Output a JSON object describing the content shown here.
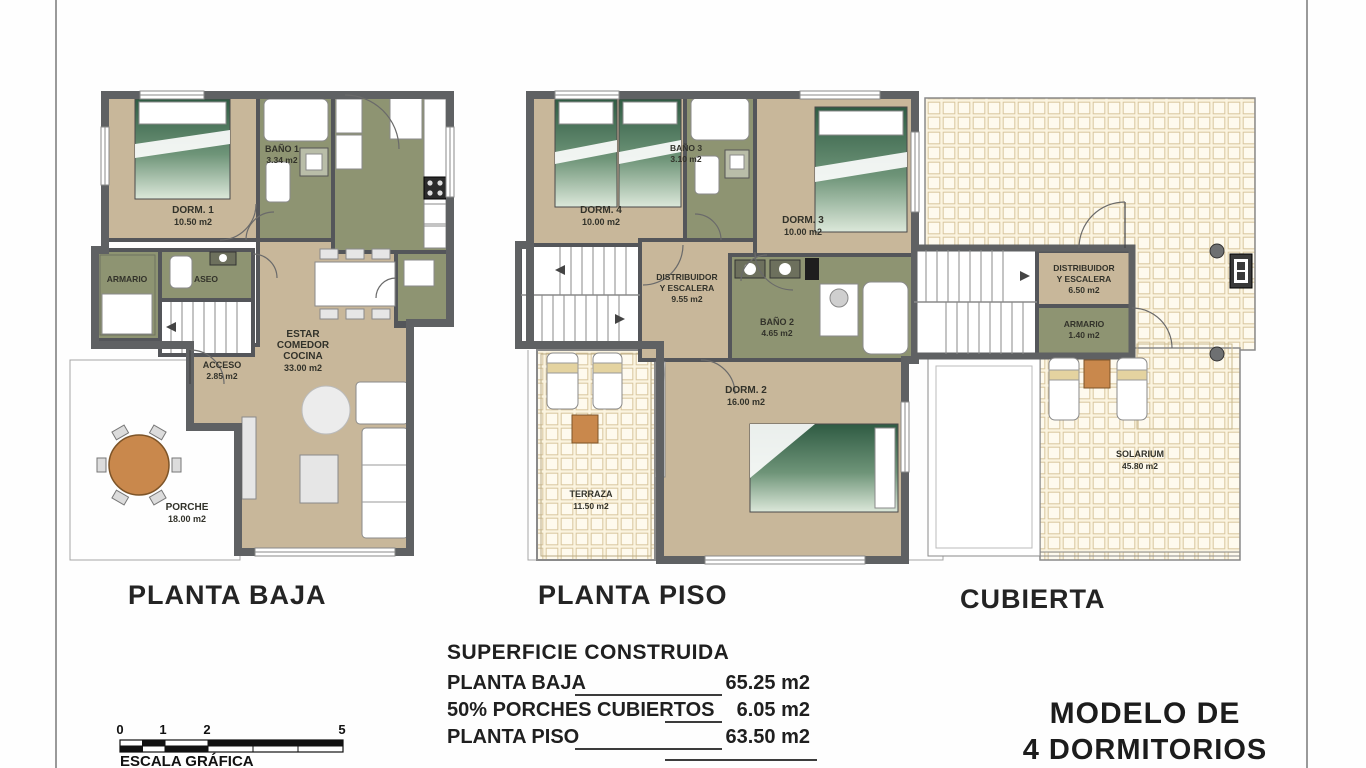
{
  "colors": {
    "wall_gray": "#5F6163",
    "floor_tan": "#C8B79A",
    "wet_room_olive": "#8E9472",
    "tile_cream": "#FBF4E0",
    "accent_orange": "#C9884C",
    "bed_green": "#2F5B43",
    "text": "#222222"
  },
  "plans": {
    "planta_baja": {
      "title": "PLANTA BAJA",
      "rooms": {
        "dorm1": {
          "lines": [
            "DORM. 1",
            "10.50 m2"
          ]
        },
        "bano1": {
          "lines": [
            "BAÑO 1",
            "3.34 m2"
          ]
        },
        "armario": {
          "lines": [
            "ARMARIO"
          ]
        },
        "aseo": {
          "lines": [
            "ASEO"
          ]
        },
        "estar": {
          "lines": [
            "ESTAR",
            "COMEDOR",
            "COCINA",
            "33.00 m2"
          ]
        },
        "acceso": {
          "lines": [
            "ACCESO",
            "2.85 m2"
          ]
        },
        "porche": {
          "lines": [
            "PORCHE",
            "18.00 m2"
          ]
        }
      }
    },
    "planta_piso": {
      "title": "PLANTA PISO",
      "rooms": {
        "dorm4": {
          "lines": [
            "DORM. 4",
            "10.00 m2"
          ]
        },
        "bano3": {
          "lines": [
            "BAÑO 3",
            "3.10 m2"
          ]
        },
        "dorm3": {
          "lines": [
            "DORM. 3",
            "10.00 m2"
          ]
        },
        "distribuidor": {
          "lines": [
            "DISTRIBUIDOR",
            "Y ESCALERA",
            "9.55 m2"
          ]
        },
        "bano2": {
          "lines": [
            "BAÑO 2",
            "4.65 m2"
          ]
        },
        "dorm2": {
          "lines": [
            "DORM. 2",
            "16.00 m2"
          ]
        },
        "terraza": {
          "lines": [
            "TERRAZA",
            "11.50 m2"
          ]
        }
      }
    },
    "cubierta": {
      "title": "CUBIERTA",
      "rooms": {
        "distribuidor": {
          "lines": [
            "DISTRIBUIDOR",
            "Y ESCALERA",
            "6.50 m2"
          ]
        },
        "armario": {
          "lines": [
            "ARMARIO",
            "1.40 m2"
          ]
        },
        "solarium": {
          "lines": [
            "SOLARIUM",
            "45.80 m2"
          ]
        }
      }
    }
  },
  "summary": {
    "title": "SUPERFICIE CONSTRUIDA",
    "rows": [
      {
        "label": "PLANTA BAJA",
        "value": "65.25 m2"
      },
      {
        "label": "50% PORCHES CUBIERTOS",
        "value": "6.05 m2"
      },
      {
        "label": "PLANTA PISO",
        "value": "63.50 m2"
      }
    ]
  },
  "scale_bar": {
    "ticks": [
      "0",
      "1",
      "2",
      "5"
    ],
    "label": "ESCALA GRÁFICA"
  },
  "model": {
    "lines": [
      "MODELO DE",
      "4 DORMITORIOS"
    ]
  }
}
